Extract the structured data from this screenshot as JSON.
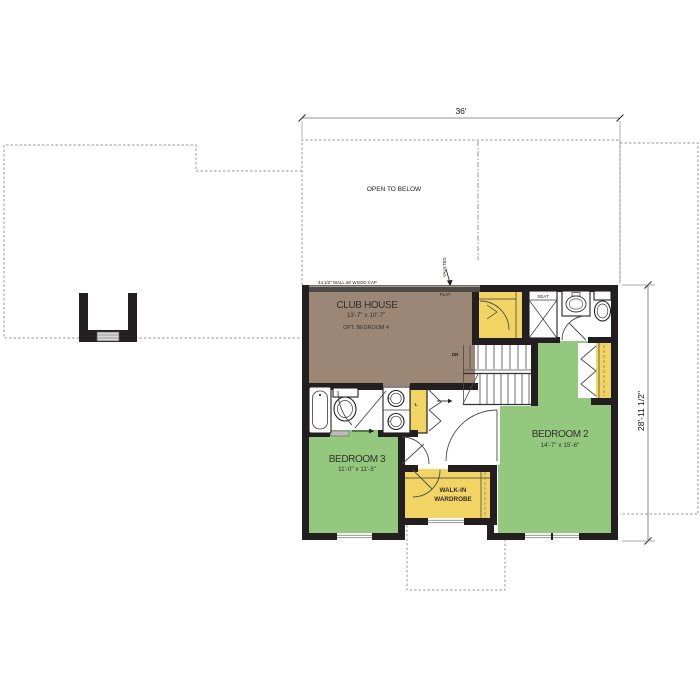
{
  "plan": {
    "title": "Second floor plan",
    "dimensions": {
      "top_width": "36'",
      "right_height": "28'-11 1/2\""
    },
    "annotations": {
      "open_to_below": "OPEN TO BELOW",
      "wall_note": "44 1/2\" WALL W/ WOOD CAP",
      "vaulted": "VAULTED",
      "flat": "FLAT",
      "seat": "SEAT",
      "down": "DN",
      "linen": "L"
    },
    "rooms": {
      "club_house": {
        "name": "CLUB HOUSE",
        "dims": "13'-7\" x 10'-7\"",
        "note": "OPT. BEDROOM 4",
        "fill": "#9c8777"
      },
      "bedroom_2": {
        "name": "BEDROOM 2",
        "dims": "14'-7\" x 15'-6\"",
        "fill": "#93c87e"
      },
      "bedroom_3": {
        "name": "BEDROOM 3",
        "dims": "11'-0\" x 11'-3\"",
        "fill": "#93c87e"
      },
      "walk_in_wardrobe": {
        "name_line1": "WALK-IN",
        "name_line2": "WARDROBE",
        "fill": "#f2d465"
      }
    },
    "colors": {
      "wall": "#231f20",
      "half_wall": "#4e4a47",
      "closet_yellow": "#f2d465",
      "room_green": "#93c87e",
      "club_brown": "#9c8777",
      "dashed_outline": "#9a9a9a",
      "background": "#ffffff"
    }
  }
}
